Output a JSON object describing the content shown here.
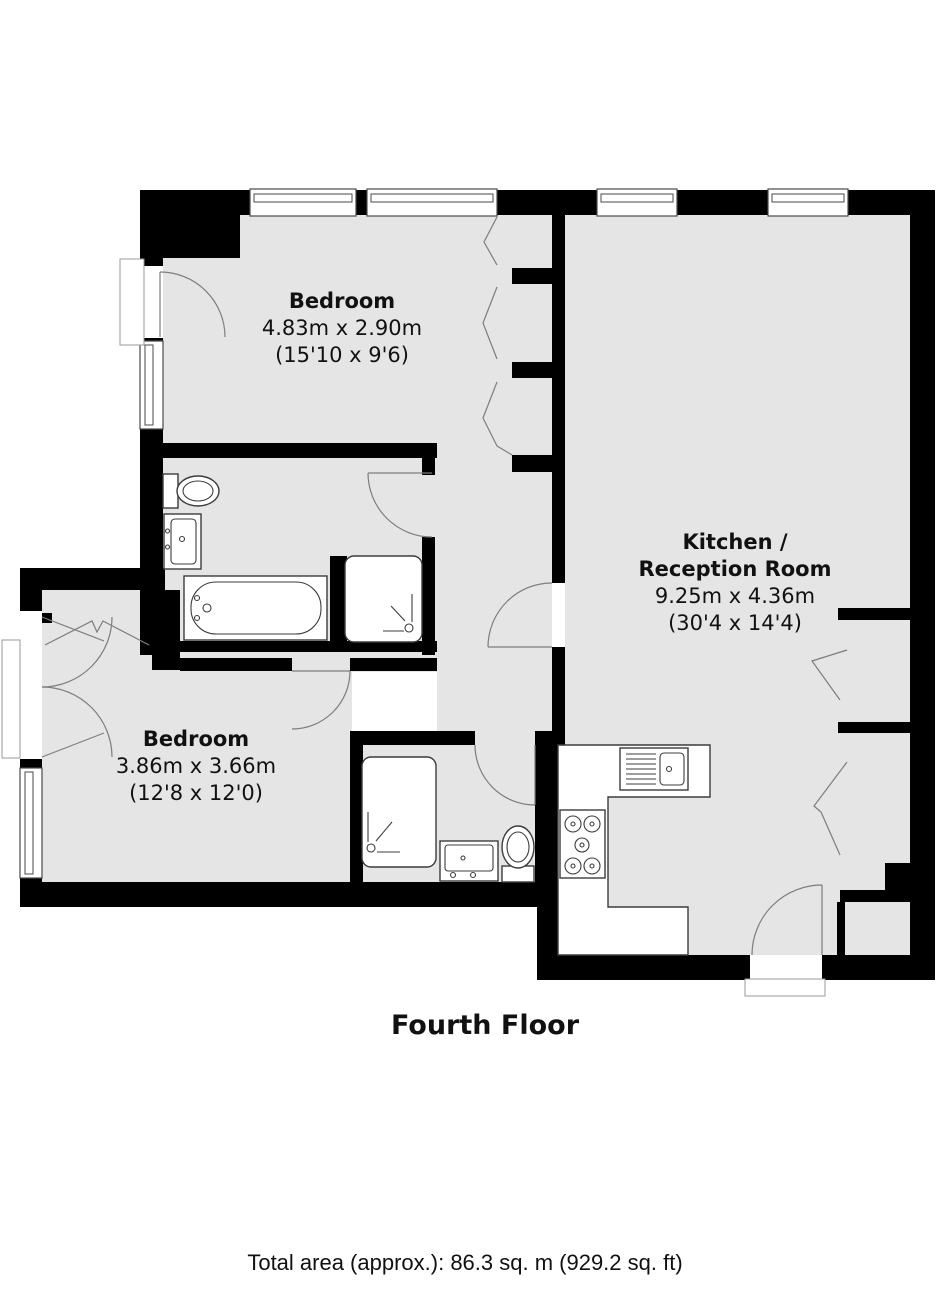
{
  "floorplan": {
    "title": "Fourth Floor",
    "total_area": "Total area (approx.): 86.3 sq. m (929.2 sq. ft)",
    "rooms": [
      {
        "id": "bedroom-1",
        "name": "Bedroom",
        "size_metric": "4.83m x 2.90m",
        "size_imperial": "(15'10 x 9'6)"
      },
      {
        "id": "kitchen-reception",
        "name_line1": "Kitchen /",
        "name_line2": "Reception Room",
        "size_metric": "9.25m x 4.36m",
        "size_imperial": "(30'4 x 14'4)"
      },
      {
        "id": "bedroom-2",
        "name": "Bedroom",
        "size_metric": "3.86m x 3.66m",
        "size_imperial": "(12'8 x 12'0)"
      }
    ],
    "fixtures": [
      "toilet",
      "washbasin",
      "bathtub",
      "shower",
      "kitchen-sink",
      "hob",
      "worktop",
      "built-in-wardrobe"
    ],
    "colors": {
      "wall": "#000000",
      "floor": "#e5e5e5",
      "fixture_line": "#3c3c3c",
      "text": "#111111"
    }
  }
}
